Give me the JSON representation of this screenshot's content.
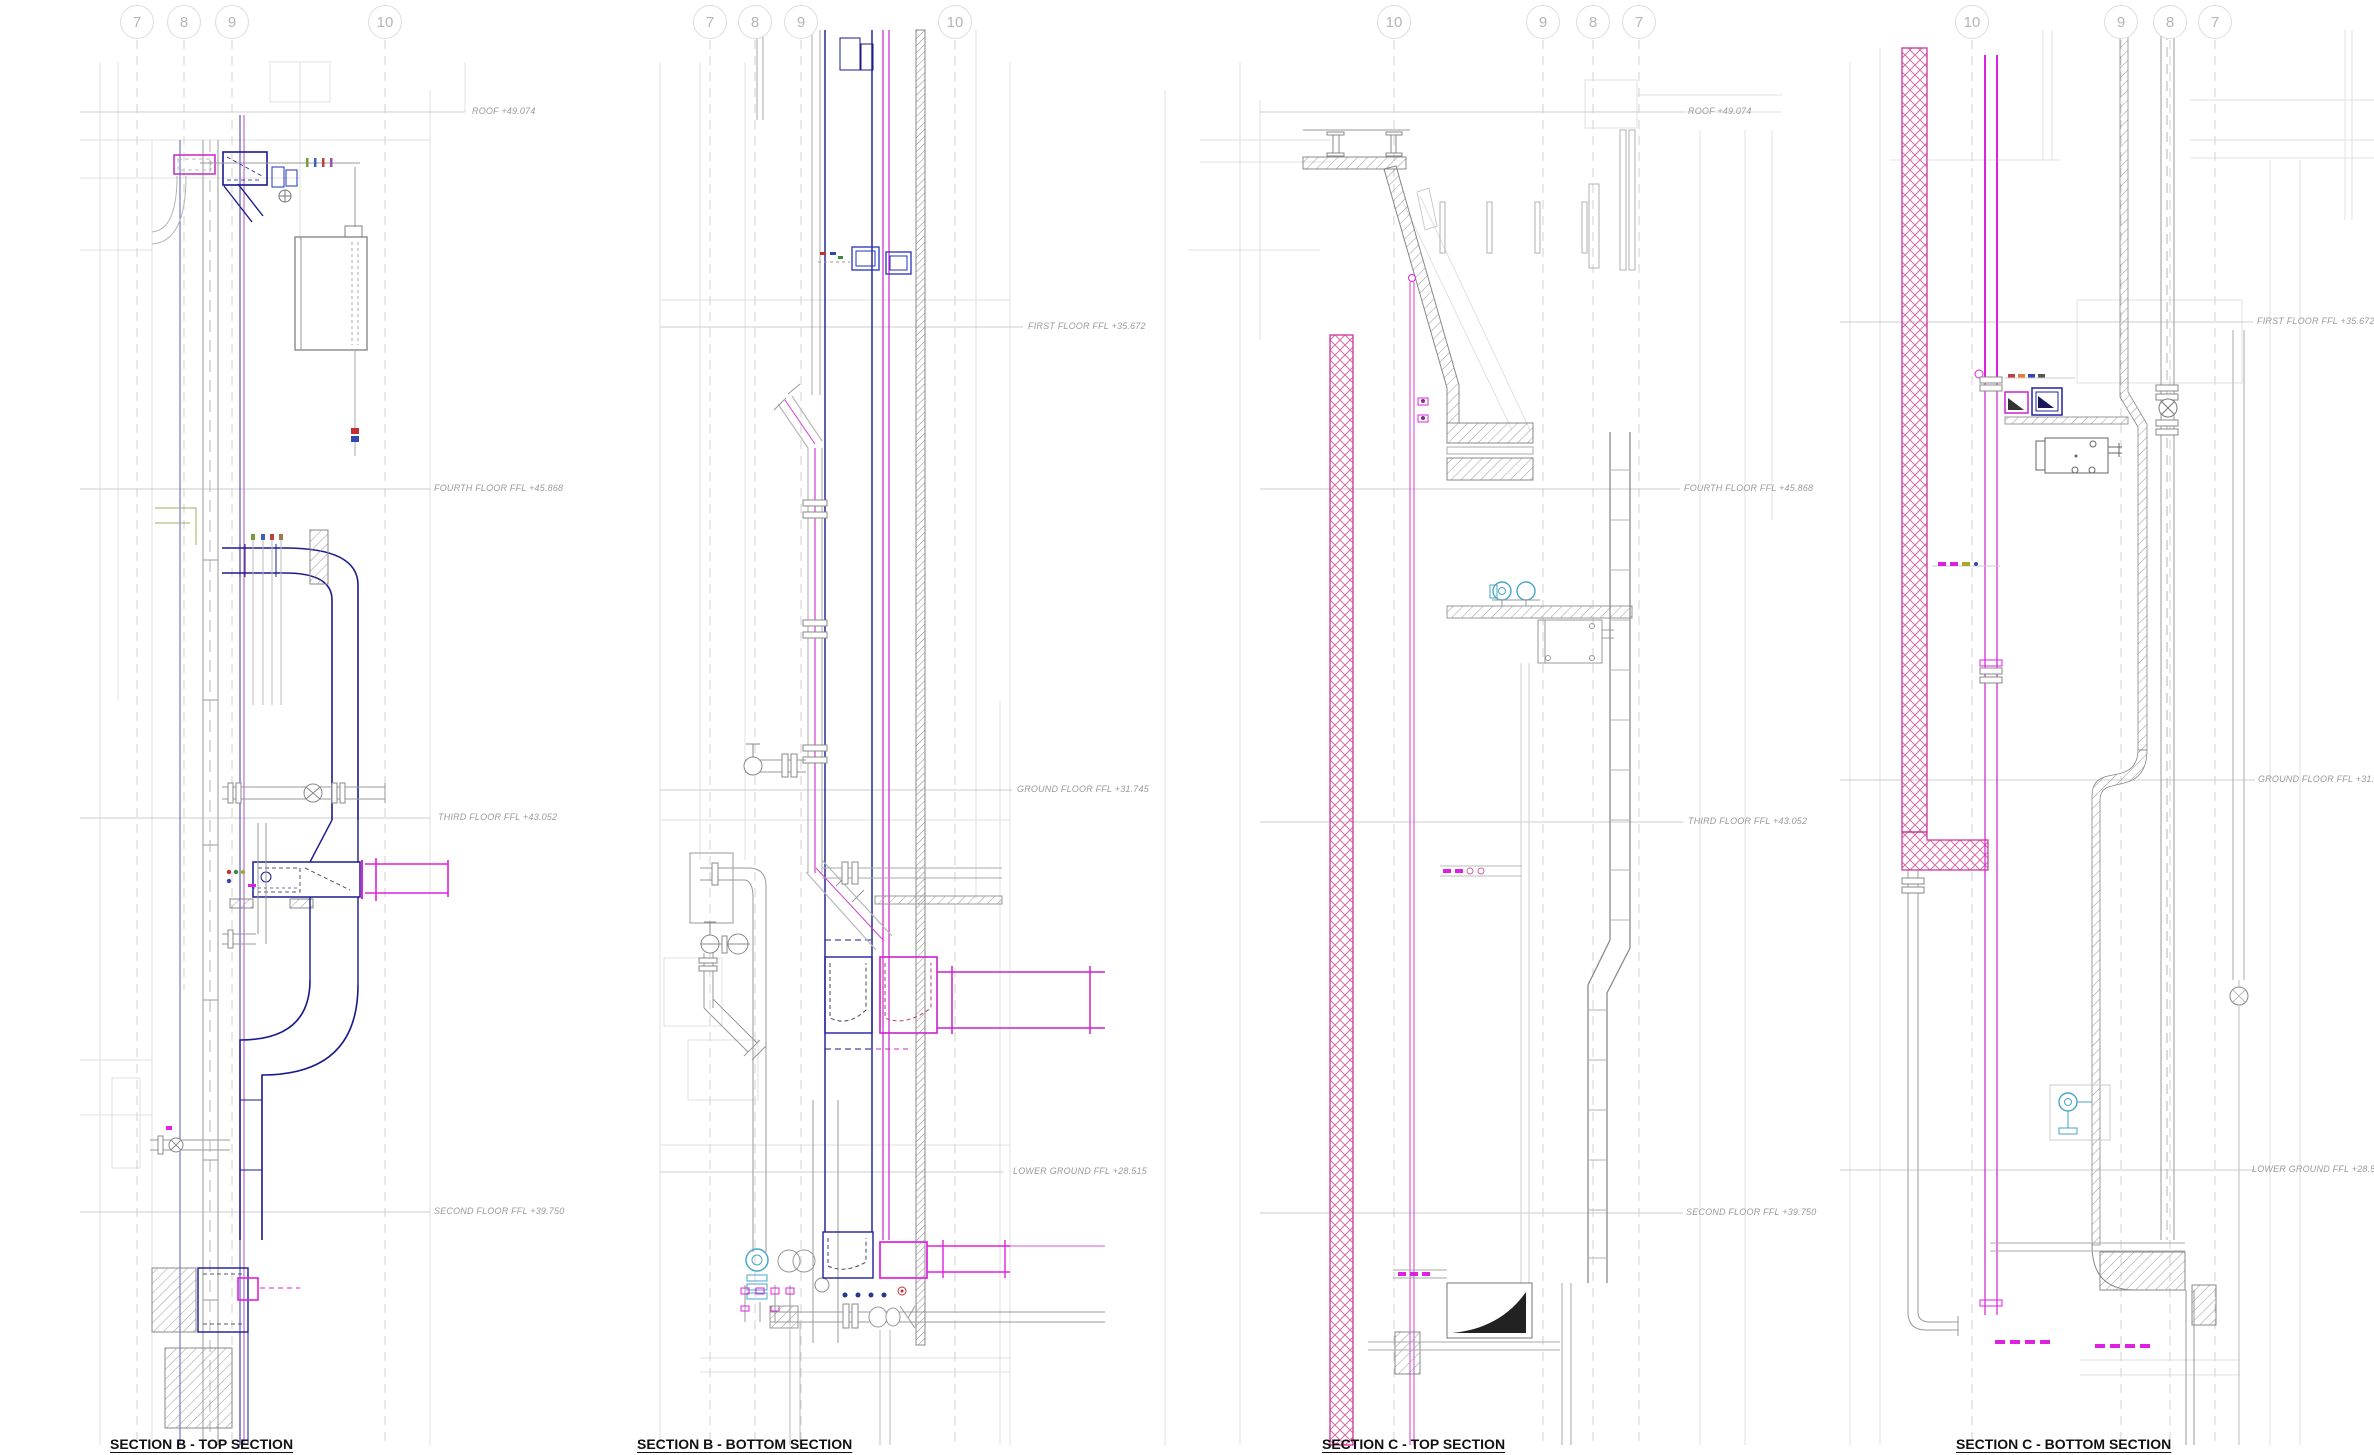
{
  "panels": [
    {
      "title": "SECTION B - TOP SECTION",
      "grid_bubbles": [
        "7",
        "8",
        "9",
        "10"
      ],
      "levels": [
        {
          "label": "ROOF +49.074"
        },
        {
          "label": "FOURTH FLOOR FFL +45.868"
        },
        {
          "label": "THIRD FLOOR FFL +43.052"
        },
        {
          "label": "SECOND FLOOR FFL +39.750"
        }
      ]
    },
    {
      "title": "SECTION B - BOTTOM SECTION",
      "grid_bubbles": [
        "7",
        "8",
        "9",
        "10"
      ],
      "levels": [
        {
          "label": "FIRST FLOOR FFL +35.672"
        },
        {
          "label": "GROUND FLOOR FFL +31.745"
        },
        {
          "label": "LOWER GROUND FFL +28.515"
        }
      ]
    },
    {
      "title": "SECTION C - TOP SECTION",
      "grid_bubbles": [
        "10",
        "9",
        "8",
        "7"
      ],
      "levels": [
        {
          "label": "ROOF +49.074"
        },
        {
          "label": "FOURTH FLOOR FFL +45.868"
        },
        {
          "label": "THIRD FLOOR FFL +43.052"
        },
        {
          "label": "SECOND FLOOR FFL +39.750"
        }
      ]
    },
    {
      "title": "SECTION C - BOTTOM SECTION",
      "grid_bubbles": [
        "10",
        "9",
        "8",
        "7"
      ],
      "levels": [
        {
          "label": "FIRST FLOOR FFL +35.672"
        },
        {
          "label": "GROUND FLOOR FFL +31.745"
        },
        {
          "label": "LOWER GROUND FFL +28.515"
        }
      ]
    }
  ],
  "colors": {
    "duct_navy": "#1b1b8e",
    "pipe_magenta": "#cc22cc",
    "bright_magenta": "#e020e0",
    "wall_pink": "#cc3399",
    "pump_cyan": "#4aa6c8",
    "linework_gray": "#9a9a9a",
    "faint_gray": "#dedede",
    "level_text": "#9a9a9a",
    "bubble_ring": "#dddddd",
    "title_text": "#111111"
  }
}
